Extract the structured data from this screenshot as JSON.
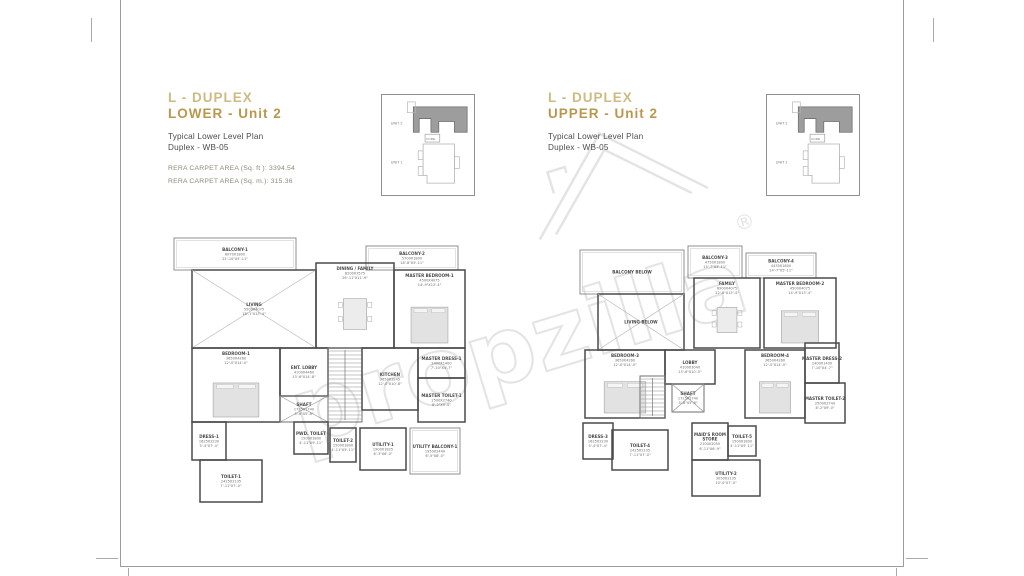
{
  "left_panel": {
    "title_line1": "L - DUPLEX",
    "title_line2": "LOWER - Unit 2",
    "subtitle_line1": "Typical Lower Level Plan",
    "subtitle_line2": "Duplex - WB-05",
    "rera_sqft": "RERA CARPET AREA (Sq. ft ): 3394.54",
    "rera_sqm": "RERA CARPET AREA (Sq. m.): 315.36"
  },
  "right_panel": {
    "title_line1": "L - DUPLEX",
    "title_line2": "UPPER - Unit 2",
    "subtitle_line1": "Typical Lower Level Plan",
    "subtitle_line2": "Duplex - WB-05"
  },
  "keyplan": {
    "unit2_label": "UNIT 2",
    "core_label": "CORE",
    "unit1_label": "UNIT 1"
  },
  "watermark": {
    "text": "propzilla",
    "registered": "®"
  },
  "colors": {
    "title_gold_light": "#cdbb83",
    "title_gold": "#b9984e",
    "subtitle_gray": "#4b4b4b",
    "rera_gray": "#8f897b",
    "wall": "#4a4a4a",
    "keyplan_unit2_fill": "#9d9d9d",
    "watermark_gray": "#e4e4e4"
  },
  "plans": {
    "lower": {
      "w": 305,
      "h": 275,
      "rooms": [
        {
          "name": "BALCONY-1",
          "mm": "6970X1800",
          "ft": "22'-10\"X5'-11\"",
          "x": 6,
          "y": 8,
          "w": 122,
          "h": 32,
          "type": "balcony"
        },
        {
          "name": "BALCONY-2",
          "mm": "5700X1800",
          "ft": "18'-8\"X5'-11\"",
          "x": 198,
          "y": 16,
          "w": 92,
          "h": 24,
          "type": "balcony"
        },
        {
          "name": "LIVING",
          "mm": "5500X4075",
          "ft": "18'-1\"X13'-4\"",
          "x": 24,
          "y": 40,
          "w": 124,
          "h": 78,
          "type": "cross"
        },
        {
          "name": "DINING / FAMILY",
          "mm": "8200X3575",
          "ft": "26'-11\"X11'-9\"",
          "x": 148,
          "y": 33,
          "w": 78,
          "h": 85,
          "furn": "table"
        },
        {
          "name": "MASTER BEDROOM-1",
          "mm": "4500X4075",
          "ft": "14'-9\"X13'-4\"",
          "x": 226,
          "y": 40,
          "w": 71,
          "h": 78,
          "furn": "bed"
        },
        {
          "name": "BEDROOM-1",
          "mm": "3650X4260",
          "ft": "12'-0\"X14'-0\"",
          "x": 24,
          "y": 118,
          "w": 88,
          "h": 74,
          "furn": "bed"
        },
        {
          "name": "ENT. LOBBY",
          "mm": "4100X4460",
          "ft": "13'-6\"X14'-8\"",
          "x": 112,
          "y": 118,
          "w": 48,
          "h": 48
        },
        {
          "name": "SHAFT",
          "mm": "1725X1740",
          "ft": "5'-8\"X5'-8\"",
          "x": 112,
          "y": 166,
          "w": 48,
          "h": 26,
          "type": "shaft"
        },
        {
          "name": "",
          "x": 160,
          "y": 118,
          "w": 34,
          "h": 74,
          "type": "stair"
        },
        {
          "name": "KITCHEN",
          "mm": "3650X3245",
          "ft": "12'-0\"X10'-8\"",
          "x": 194,
          "y": 118,
          "w": 56,
          "h": 62
        },
        {
          "name": "MASTER DRESS-1",
          "mm": "2400X1400",
          "ft": "7'-10\"X4'-7\"",
          "x": 250,
          "y": 118,
          "w": 47,
          "h": 30
        },
        {
          "name": "MASTER TOILET-1",
          "mm": "2500X2740",
          "ft": "8'-2\"X9'-0\"",
          "x": 250,
          "y": 148,
          "w": 47,
          "h": 44
        },
        {
          "name": "DRESS-1",
          "mm": "1625X2230",
          "ft": "5'-4\"X7'-4\"",
          "x": 24,
          "y": 192,
          "w": 34,
          "h": 38
        },
        {
          "name": "TOILET-1",
          "mm": "2425X2135",
          "ft": "7'-11\"X7'-0\"",
          "x": 32,
          "y": 230,
          "w": 62,
          "h": 42
        },
        {
          "name": "PWD. TOILET",
          "mm": "1500X1800",
          "ft": "4'-11\"X5'-11\"",
          "x": 126,
          "y": 192,
          "w": 34,
          "h": 32
        },
        {
          "name": "TOILET-2",
          "mm": "1500X1800",
          "ft": "4'-11\"X5'-11\"",
          "x": 162,
          "y": 198,
          "w": 26,
          "h": 34
        },
        {
          "name": "UTILITY-1",
          "mm": "1900X1825",
          "ft": "6'-3\"X6'-0\"",
          "x": 192,
          "y": 198,
          "w": 46,
          "h": 42
        },
        {
          "name": "UTILITY BALCONY-1",
          "mm": "1950X2440",
          "ft": "6'-5\"X8'-0\"",
          "x": 242,
          "y": 198,
          "w": 50,
          "h": 46,
          "type": "balcony"
        }
      ]
    },
    "upper": {
      "w": 290,
      "h": 275,
      "rooms": [
        {
          "name": "BALCONY BELOW",
          "x": 4,
          "y": 20,
          "w": 104,
          "h": 44,
          "type": "balcony"
        },
        {
          "name": "BALCONY-3",
          "mm": "4750X1800",
          "ft": "15'-7\"X5'-11\"",
          "x": 112,
          "y": 16,
          "w": 54,
          "h": 32,
          "type": "balcony"
        },
        {
          "name": "BALCONY-4",
          "mm": "4435X1800",
          "ft": "14'-7\"X5'-11\"",
          "x": 170,
          "y": 23,
          "w": 70,
          "h": 25,
          "type": "balcony"
        },
        {
          "name": "LIVING BELOW",
          "x": 22,
          "y": 64,
          "w": 86,
          "h": 56,
          "type": "cross"
        },
        {
          "name": "FAMILY",
          "mm": "6900X4075",
          "ft": "22'-8\"X13'-4\"",
          "x": 118,
          "y": 48,
          "w": 66,
          "h": 70,
          "furn": "table"
        },
        {
          "name": "MASTER BEDROOM-2",
          "mm": "4500X4075",
          "ft": "14'-9\"X13'-4\"",
          "x": 188,
          "y": 48,
          "w": 72,
          "h": 70,
          "furn": "bed"
        },
        {
          "name": "BEDROOM-3",
          "mm": "3650X4260",
          "ft": "12'-0\"X14'-0\"",
          "x": 9,
          "y": 120,
          "w": 80,
          "h": 68,
          "furn": "bed"
        },
        {
          "name": "LOBBY",
          "mm": "4100X3040",
          "ft": "13'-6\"X10'-0\"",
          "x": 89,
          "y": 120,
          "w": 50,
          "h": 34
        },
        {
          "name": "",
          "x": 64,
          "y": 146,
          "w": 25,
          "h": 42,
          "type": "stair"
        },
        {
          "name": "SHAFT",
          "mm": "1725X1740",
          "ft": "5'-8\"X5'-8\"",
          "x": 96,
          "y": 154,
          "w": 32,
          "h": 28,
          "type": "shaft"
        },
        {
          "name": "BEDROOM-4",
          "mm": "3650X4260",
          "ft": "12'-0\"X14'-0\"",
          "x": 169,
          "y": 120,
          "w": 60,
          "h": 68,
          "furn": "bed"
        },
        {
          "name": "MASTER DRESS-2",
          "mm": "2400X1400",
          "ft": "7'-10\"X4'-7\"",
          "x": 229,
          "y": 113,
          "w": 34,
          "h": 40
        },
        {
          "name": "MASTER TOILET-2",
          "mm": "2500X2740",
          "ft": "8'-2\"X9'-0\"",
          "x": 229,
          "y": 153,
          "w": 40,
          "h": 40
        },
        {
          "name": "DRESS-3",
          "mm": "1625X2230",
          "ft": "5'-4\"X7'-4\"",
          "x": 7,
          "y": 193,
          "w": 30,
          "h": 36
        },
        {
          "name": "TOILET-4",
          "mm": "2425X2135",
          "ft": "7'-11\"X7'-0\"",
          "x": 36,
          "y": 200,
          "w": 56,
          "h": 40
        },
        {
          "name": "MAID'S ROOM / STORE",
          "mm": "2100X2050",
          "ft": "6'-11\"X6'-9\"",
          "x": 116,
          "y": 193,
          "w": 36,
          "h": 37
        },
        {
          "name": "TOILET-5",
          "mm": "1500X1800",
          "ft": "4'-11\"X5'-11\"",
          "x": 152,
          "y": 196,
          "w": 28,
          "h": 30
        },
        {
          "name": "UTILITY-2",
          "mm": "3050X2135",
          "ft": "10'-0\"X7'-0\"",
          "x": 116,
          "y": 230,
          "w": 68,
          "h": 36
        }
      ]
    }
  }
}
